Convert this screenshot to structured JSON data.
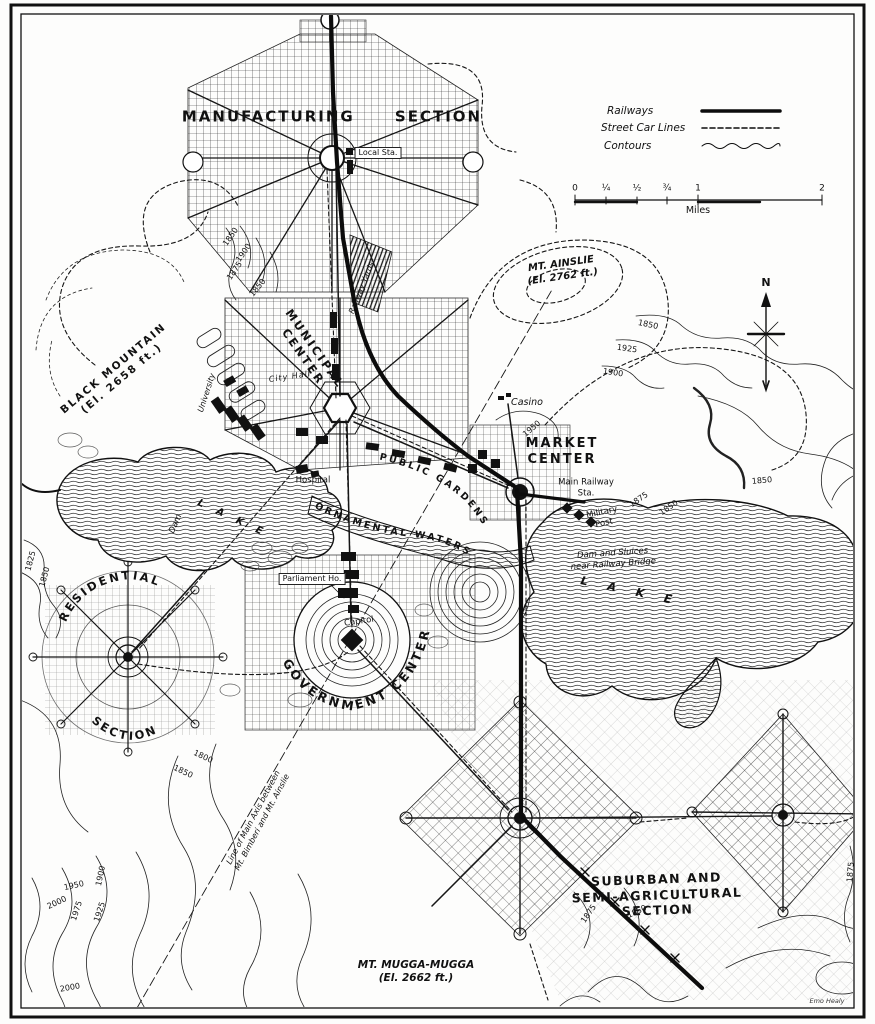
{
  "legend": {
    "items": [
      {
        "name": "railways",
        "label": "Railways",
        "style": "solid"
      },
      {
        "name": "street_car_lines",
        "label": "Street Car Lines",
        "style": "dashed"
      },
      {
        "name": "contours",
        "label": "Contours",
        "style": "wavy"
      }
    ]
  },
  "scale_bar": {
    "ticks": [
      "0",
      "¼",
      "½",
      "¾",
      "1",
      "2"
    ],
    "unit": "Miles"
  },
  "compass": {
    "north": "N"
  },
  "labels": {
    "manufacturing_section": "MANUFACTURING SECTION",
    "local_station": "Local Sta.",
    "railway_yards": "Railway Yards",
    "black_mountain": "BLACK MOUNTAIN\n(El. 2658 ft.)",
    "mt_ainslie": "MT. AINSLIE\n(El. 2762 ft.)",
    "municipal_center": "MUNICIPAL\nCENTER",
    "university": "University",
    "city_hall": "City Hall",
    "casino": "Casino",
    "market_center": "MARKET\nCENTER",
    "main_railway_station": "Main Railway\nSta.",
    "military_post": "Military\nPost",
    "hospital": "Hospital",
    "public_gardens": "PUBLIC GARDENS",
    "ornamental_waters": "ORNAMENTAL WATERS",
    "parliament_house": "Parliament Ho.",
    "capitol": "Capitol",
    "government_center": "GOVERNMENT CENTER",
    "residential": "RESIDENTIAL",
    "residential_section": "SECTION",
    "dam": "Dam",
    "lake_west": "LAKE",
    "lake_east": "LAKE",
    "dam_and_sluices": "Dam and Sluices\nnear Railway Bridge",
    "main_axis": "Line of Main Axis between\nMt. Bimberi and Mt. Ainslie",
    "suburban_section": "SUBURBAN AND\nSEMI-AGRICULTURAL\nSECTION",
    "mt_mugga_mugga": "MT. MUGGA-MUGGA\n(El. 2662 ft.)"
  },
  "signature": "Emo Healy",
  "contour_labels": [
    {
      "value": "1850",
      "x": 231,
      "y": 237,
      "rot": -55
    },
    {
      "value": "1900",
      "x": 244,
      "y": 253,
      "rot": -55
    },
    {
      "value": "1875",
      "x": 235,
      "y": 271,
      "rot": -55
    },
    {
      "value": "1850",
      "x": 258,
      "y": 288,
      "rot": -50
    },
    {
      "value": "1850",
      "x": 648,
      "y": 325,
      "rot": 12
    },
    {
      "value": "1925",
      "x": 627,
      "y": 349,
      "rot": 8
    },
    {
      "value": "1900",
      "x": 613,
      "y": 373,
      "rot": 8
    },
    {
      "value": "1850",
      "x": 762,
      "y": 481,
      "rot": -5
    },
    {
      "value": "1875",
      "x": 639,
      "y": 500,
      "rot": -35
    },
    {
      "value": "1850",
      "x": 669,
      "y": 508,
      "rot": -35
    },
    {
      "value": "1950",
      "x": 532,
      "y": 429,
      "rot": -40
    },
    {
      "value": "1825",
      "x": 31,
      "y": 561,
      "rot": -75
    },
    {
      "value": "1850",
      "x": 45,
      "y": 577,
      "rot": -75
    },
    {
      "value": "1800",
      "x": 203,
      "y": 757,
      "rot": 25
    },
    {
      "value": "1850",
      "x": 183,
      "y": 772,
      "rot": 25
    },
    {
      "value": "1950",
      "x": 74,
      "y": 886,
      "rot": -12
    },
    {
      "value": "1900",
      "x": 101,
      "y": 876,
      "rot": -78
    },
    {
      "value": "2000",
      "x": 57,
      "y": 903,
      "rot": -25
    },
    {
      "value": "1975",
      "x": 77,
      "y": 911,
      "rot": -72
    },
    {
      "value": "1925",
      "x": 100,
      "y": 912,
      "rot": -72
    },
    {
      "value": "2000",
      "x": 70,
      "y": 988,
      "rot": -10
    },
    {
      "value": "1875",
      "x": 851,
      "y": 872,
      "rot": -85
    },
    {
      "value": "1875",
      "x": 589,
      "y": 914,
      "rot": -55
    },
    {
      "value": "1850",
      "x": 637,
      "y": 912,
      "rot": -25
    }
  ],
  "colors": {
    "ink": "#141414",
    "paper": "#fdfdfc"
  }
}
